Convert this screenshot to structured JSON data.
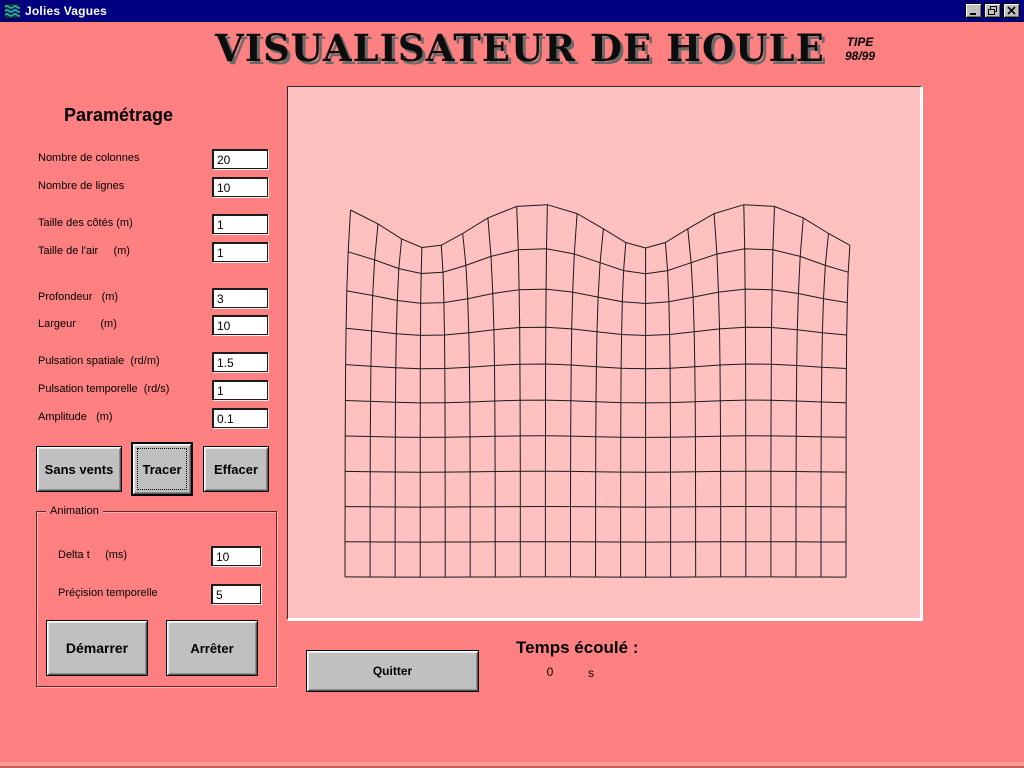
{
  "window": {
    "title": "Jolies Vagues",
    "icons": {
      "app": "waves-icon",
      "minimize": "minimize-icon",
      "restore": "restore-icon",
      "close": "close-icon"
    }
  },
  "header": {
    "title": "VISUALISATEUR DE HOULE",
    "badge_line1": "TIPE",
    "badge_line2": "98/99"
  },
  "params": {
    "heading": "Paramétrage",
    "fields": [
      {
        "label": "Nombre de colonnes",
        "value": "20"
      },
      {
        "label": "Nombre de lignes",
        "value": "10"
      },
      {
        "label": "Taille des côtés (m)",
        "value": "1"
      },
      {
        "label": "Taille de l'air     (m)",
        "value": "1"
      },
      {
        "label": "Profondeur   (m)",
        "value": "3"
      },
      {
        "label": "Largeur        (m)",
        "value": "10"
      },
      {
        "label": "Pulsation spatiale  (rd/m)",
        "value": "1.5"
      },
      {
        "label": "Pulsation temporelle  (rd/s)",
        "value": "1"
      },
      {
        "label": "Amplitude   (m)",
        "value": "0.1"
      }
    ]
  },
  "actions": {
    "sans_vents": "Sans vents",
    "tracer": "Tracer",
    "effacer": "Effacer"
  },
  "animation": {
    "title": "Animation",
    "fields": [
      {
        "label": "Delta t     (ms)",
        "value": "10"
      },
      {
        "label": "Préçision temporelle",
        "value": "5"
      }
    ],
    "start": "Démarrer",
    "stop": "Arrêter"
  },
  "footer": {
    "quit": "Quitter",
    "elapsed_label": "Temps écoulé :",
    "elapsed_value": "0",
    "elapsed_unit": "s"
  },
  "colors": {
    "background": "#FF8080",
    "canvas": "#FFC0C0",
    "titlebar": "#000080",
    "button_face": "#C0C0C0",
    "mesh_stroke": "#1a1a1a"
  },
  "wave_mesh": {
    "columns": 20,
    "rows": 10,
    "left": 57,
    "top_mean": 139,
    "col_width": 25.05,
    "row_height": 35.1,
    "amplitude_px": 22,
    "x_amplitude_px": 8,
    "periods": 2.3,
    "phase": 0.12,
    "depth_decay": 0.55,
    "stroke": "#1a1a1a"
  }
}
